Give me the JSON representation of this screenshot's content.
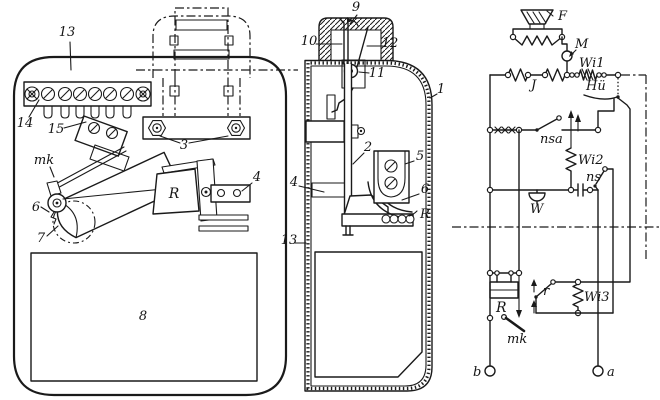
{
  "figure": {
    "background": "#ffffff",
    "ink": "#1a1a1a"
  },
  "front": {
    "l13": "13",
    "l14": "14",
    "l15": "15",
    "lmk": "mk",
    "l3": "3",
    "lR": "R",
    "l4": "4",
    "l6": "6",
    "l7": "7",
    "l8": "8"
  },
  "side": {
    "l9": "9",
    "l10": "10",
    "l12": "12",
    "l11": "11",
    "l1": "1",
    "l2": "2",
    "l5": "5",
    "l4": "4",
    "l6": "6",
    "lR": "R",
    "l13": "13"
  },
  "circuit": {
    "lF": "F",
    "lM": "M",
    "lWi1": "Wi1",
    "lJ": "J",
    "lHu": "Hü",
    "lnsa": "nsa",
    "lWi2": "Wi2",
    "lns": "ns",
    "lW": "W",
    "lR": "R",
    "lr": "r",
    "lWi3": "Wi3",
    "lmk": "mk",
    "lb": "b",
    "la": "a"
  }
}
